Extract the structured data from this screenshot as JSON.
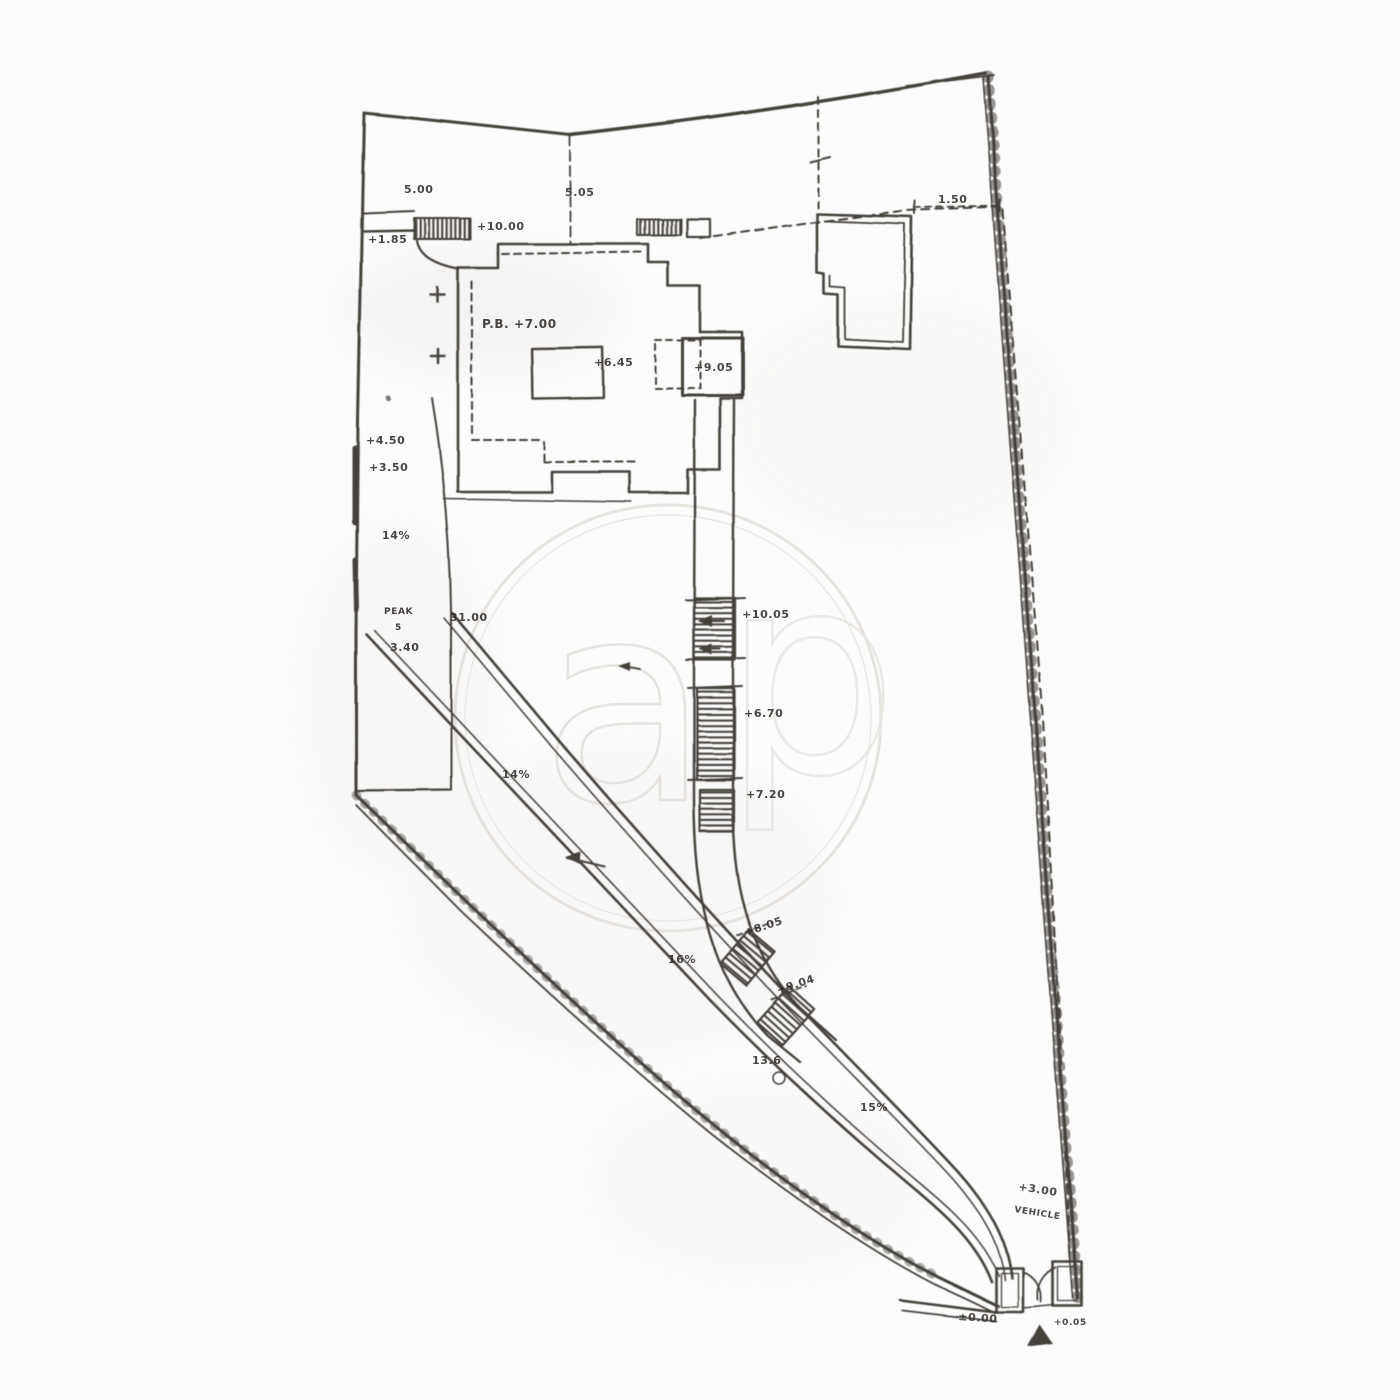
{
  "page": {
    "background_color": "#ffffff",
    "ink_color": "#35302c",
    "watermark_color": "#e3e0db",
    "description_labels_note": "scanned architectural site plan, pencil linework"
  },
  "watermark": {
    "letter_a": "a",
    "letter_p": "p"
  },
  "annotations": [
    {
      "text": "5.00",
      "kind": "dimension"
    },
    {
      "text": "5.05",
      "kind": "dimension"
    },
    {
      "text": "1.50",
      "kind": "dimension"
    },
    {
      "text": "+1.85",
      "kind": "elevation"
    },
    {
      "text": "+10.00",
      "kind": "elevation"
    },
    {
      "text": "P.B. +7.00",
      "kind": "elevation"
    },
    {
      "text": "+6.45",
      "kind": "elevation"
    },
    {
      "text": "+9.05",
      "kind": "elevation"
    },
    {
      "text": "+4.50",
      "kind": "elevation"
    },
    {
      "text": "+3.50",
      "kind": "elevation"
    },
    {
      "text": "14%",
      "kind": "slope"
    },
    {
      "text": "PEAK",
      "kind": "note"
    },
    {
      "text": "5",
      "kind": "note"
    },
    {
      "text": "31.00",
      "kind": "dimension"
    },
    {
      "text": "3.40",
      "kind": "dimension"
    },
    {
      "text": "+10.05",
      "kind": "elevation"
    },
    {
      "text": "+6.70",
      "kind": "elevation"
    },
    {
      "text": "+7.20",
      "kind": "elevation"
    },
    {
      "text": "14%",
      "kind": "slope"
    },
    {
      "text": "16%",
      "kind": "slope"
    },
    {
      "text": "+8.05",
      "kind": "elevation"
    },
    {
      "text": "+9.04",
      "kind": "elevation"
    },
    {
      "text": "13.6",
      "kind": "dimension"
    },
    {
      "text": "15%",
      "kind": "slope"
    },
    {
      "text": "+3.00",
      "kind": "elevation"
    },
    {
      "text": "VEHICLE",
      "kind": "note"
    },
    {
      "text": "±0.00",
      "kind": "elevation"
    },
    {
      "text": "+0.05",
      "kind": "elevation"
    }
  ]
}
